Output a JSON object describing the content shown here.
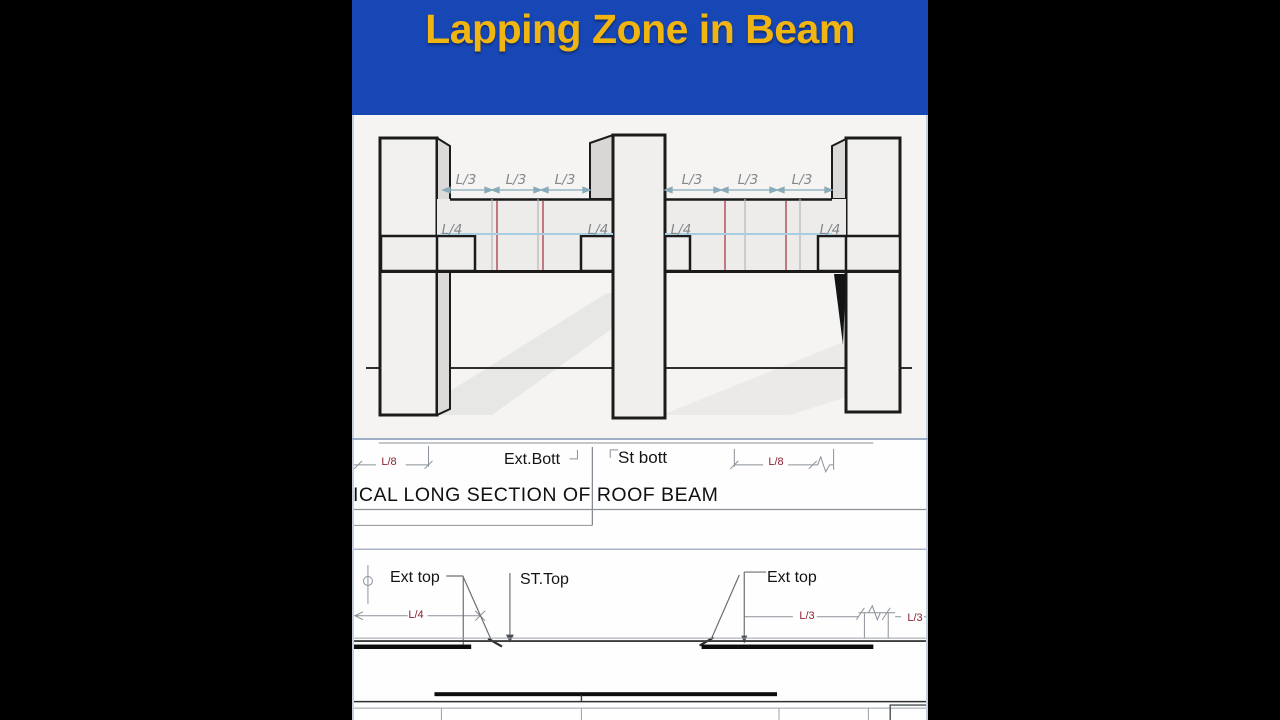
{
  "header": {
    "title": "Lapping Zone in Beam"
  },
  "colors": {
    "header_bg": "#1747b5",
    "title_text": "#f1b512",
    "dim_red": "#8e2133",
    "rebar_red_line": "#b4525c",
    "lap_blue_line": "#a6cde0",
    "arrow_teal": "#88abb9",
    "sketch_label_gray": "#84888a"
  },
  "top_diagram": {
    "l3_labels": [
      "L/3",
      "L/3",
      "L/3",
      "L/3",
      "L/3",
      "L/3"
    ],
    "l4_labels": [
      "L/4",
      "L/4",
      "L/4",
      "L/4"
    ]
  },
  "roof_beam_section": {
    "dim_left": "L/8",
    "label_ext_bott": "Ext.Bott",
    "label_st_bott": "St bott",
    "dim_right": "L/8",
    "caption": "ICAL LONG SECTION OF ROOF BEAM"
  },
  "floor_beam_section": {
    "label_ext_top_left": "Ext top",
    "label_st_top": "ST.Top",
    "label_ext_top_right": "Ext top",
    "dim_l4": "L/4",
    "dim_l3_first": "L/3",
    "dim_l3_second": "L/3"
  }
}
